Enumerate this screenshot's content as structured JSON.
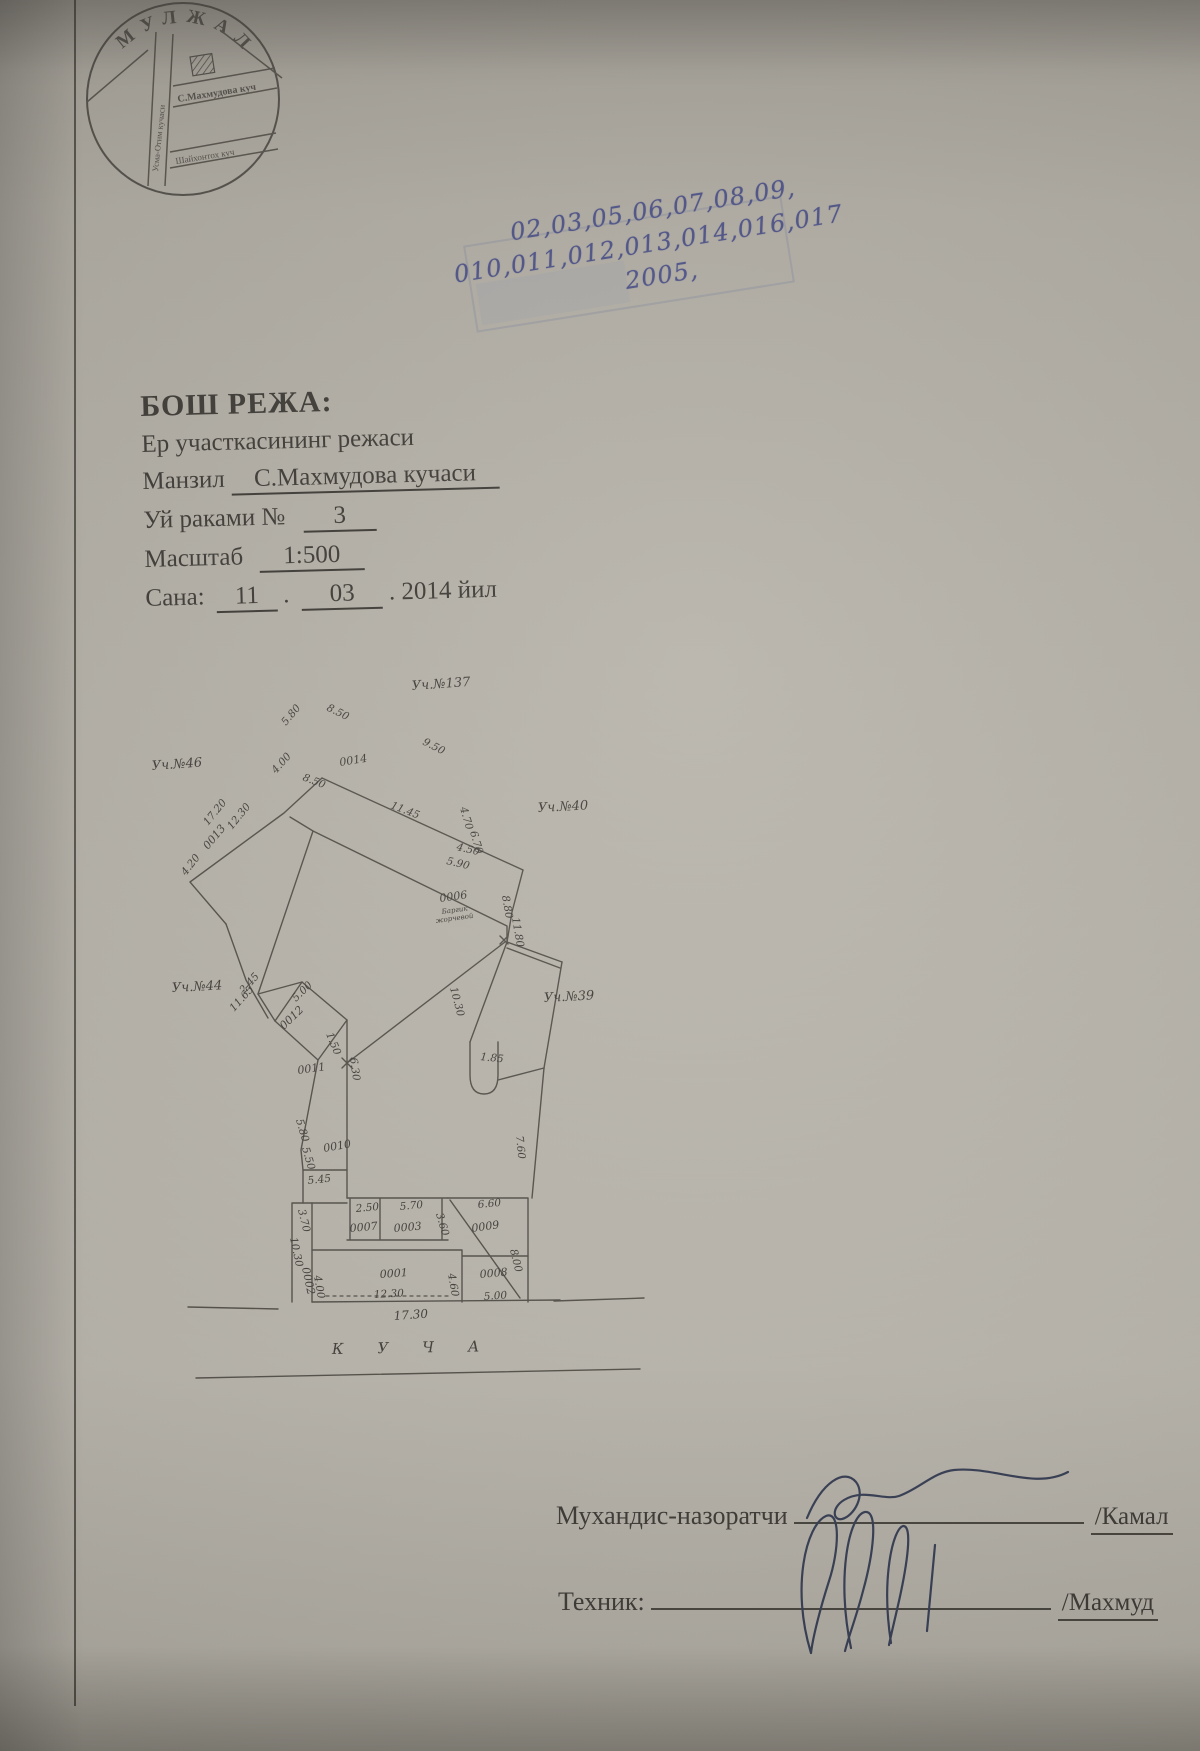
{
  "colors": {
    "paper": "#b7b3aa",
    "ink": "#57544d",
    "text": "#403d38",
    "pen_blue": "#4f5489",
    "signature_ink": "#3a4157"
  },
  "seal": {
    "arc": "МУЛЖАЛ",
    "street_vertical": "Усма-Отим кучаси",
    "street_horizontal": "С.Махмудова куч",
    "street_bottom": "Шайхонтох куч"
  },
  "stamp": {
    "line1": "02,03,05,06,07,08,09,",
    "line2": "010,011,012,013,014,016,017",
    "line3": "2005,"
  },
  "header": {
    "title": "БОШ РЕЖА:",
    "subtitle": "Ер участкасининг режаси",
    "address_label": "Манзил",
    "address_value": "С.Махмудова кучаси",
    "house_label": "Уй раками №",
    "house_value": "3",
    "scale_label": "Масштаб",
    "scale_value": "1:500",
    "date_label": "Сана:",
    "date_day": "11",
    "date_dot1": ".",
    "date_month": "03",
    "date_suffix": ". 2014 йил"
  },
  "plan": {
    "street_caption": "КУЧА",
    "labels": [
      {
        "t": "Уч.№137",
        "x": 262,
        "y": 40,
        "r": -4,
        "s": 13
      },
      {
        "t": "Уч.№46",
        "x": 2,
        "y": 120,
        "r": -4,
        "s": 13
      },
      {
        "t": "Уч.№40",
        "x": 388,
        "y": 162,
        "r": -3,
        "s": 13
      },
      {
        "t": "Уч.№44",
        "x": 22,
        "y": 342,
        "r": -3,
        "s": 13
      },
      {
        "t": "Уч.№39",
        "x": 394,
        "y": 352,
        "r": -3,
        "s": 13
      },
      {
        "t": "0014",
        "x": 190,
        "y": 116,
        "r": -9,
        "s": 11
      },
      {
        "t": "8.50",
        "x": 176,
        "y": 60,
        "r": 26,
        "s": 10.5
      },
      {
        "t": "5.80",
        "x": 136,
        "y": 76,
        "r": -50,
        "s": 10.5
      },
      {
        "t": "9.50",
        "x": 272,
        "y": 94,
        "r": 27,
        "s": 10.5
      },
      {
        "t": "4.00",
        "x": 126,
        "y": 124,
        "r": -48,
        "s": 10.5
      },
      {
        "t": "8.50",
        "x": 152,
        "y": 130,
        "r": 21,
        "s": 10.5
      },
      {
        "t": "11.45",
        "x": 240,
        "y": 158,
        "r": 21,
        "s": 10.5
      },
      {
        "t": "4.70",
        "x": 310,
        "y": 158,
        "r": 74,
        "s": 10.5
      },
      {
        "t": "6.70",
        "x": 320,
        "y": 182,
        "r": 74,
        "s": 10.5
      },
      {
        "t": "17.20",
        "x": 58,
        "y": 176,
        "r": -51,
        "s": 10.5
      },
      {
        "t": "12.30",
        "x": 82,
        "y": 180,
        "r": -51,
        "s": 10.5
      },
      {
        "t": "0013",
        "x": 58,
        "y": 200,
        "r": -50,
        "s": 11
      },
      {
        "t": "4.20",
        "x": 36,
        "y": 226,
        "r": -52,
        "s": 10.5
      },
      {
        "t": "4.50",
        "x": 306,
        "y": 200,
        "r": 13,
        "s": 10.5
      },
      {
        "t": "5.90",
        "x": 296,
        "y": 214,
        "r": 13,
        "s": 10.5
      },
      {
        "t": "0006",
        "x": 290,
        "y": 252,
        "r": -8,
        "s": 11
      },
      {
        "t": "Баргик",
        "x": 292,
        "y": 264,
        "r": -8,
        "s": 7
      },
      {
        "t": "жорчевой",
        "x": 286,
        "y": 273,
        "r": -8,
        "s": 7
      },
      {
        "t": "8.80",
        "x": 352,
        "y": 246,
        "r": 80,
        "s": 10.5
      },
      {
        "t": "11.80",
        "x": 362,
        "y": 268,
        "r": 80,
        "s": 10.5
      },
      {
        "t": "10.30",
        "x": 300,
        "y": 338,
        "r": 75,
        "s": 10.5
      },
      {
        "t": "1.85",
        "x": 330,
        "y": 410,
        "r": 6,
        "s": 10.5
      },
      {
        "t": "5.00",
        "x": 146,
        "y": 352,
        "r": -44,
        "s": 10.5
      },
      {
        "t": "2.45",
        "x": 94,
        "y": 344,
        "r": -48,
        "s": 10.5
      },
      {
        "t": "11.65",
        "x": 84,
        "y": 362,
        "r": -48,
        "s": 10.5
      },
      {
        "t": "0012",
        "x": 134,
        "y": 380,
        "r": -44,
        "s": 11
      },
      {
        "t": "1.50",
        "x": 176,
        "y": 384,
        "r": 68,
        "s": 10.5
      },
      {
        "t": "0011",
        "x": 148,
        "y": 424,
        "r": -8,
        "s": 11
      },
      {
        "t": "6.30",
        "x": 200,
        "y": 408,
        "r": 82,
        "s": 10.5
      },
      {
        "t": "5.80",
        "x": 146,
        "y": 470,
        "r": 74,
        "s": 10.5
      },
      {
        "t": "5.50",
        "x": 152,
        "y": 498,
        "r": 74,
        "s": 10.5
      },
      {
        "t": "0010",
        "x": 174,
        "y": 502,
        "r": -10,
        "s": 11
      },
      {
        "t": "7.60",
        "x": 366,
        "y": 486,
        "r": 84,
        "s": 10.5
      },
      {
        "t": "5.45",
        "x": 158,
        "y": 534,
        "r": -6,
        "s": 10.5
      },
      {
        "t": "3.70",
        "x": 148,
        "y": 560,
        "r": 76,
        "s": 10.5
      },
      {
        "t": "10.30",
        "x": 140,
        "y": 588,
        "r": 78,
        "s": 10.5
      },
      {
        "t": "0002",
        "x": 152,
        "y": 618,
        "r": 78,
        "s": 11
      },
      {
        "t": "2.50",
        "x": 206,
        "y": 562,
        "r": -5,
        "s": 10.5
      },
      {
        "t": "0007",
        "x": 200,
        "y": 582,
        "r": -5,
        "s": 11
      },
      {
        "t": "5.70",
        "x": 250,
        "y": 560,
        "r": -5,
        "s": 10.5
      },
      {
        "t": "0003",
        "x": 244,
        "y": 582,
        "r": -5,
        "s": 11
      },
      {
        "t": "3.60",
        "x": 286,
        "y": 564,
        "r": 74,
        "s": 10.5
      },
      {
        "t": "6.60",
        "x": 328,
        "y": 558,
        "r": -5,
        "s": 10.5
      },
      {
        "t": "0009",
        "x": 322,
        "y": 582,
        "r": -8,
        "s": 11
      },
      {
        "t": "0001",
        "x": 230,
        "y": 628,
        "r": -4,
        "s": 11
      },
      {
        "t": "12.30",
        "x": 224,
        "y": 648,
        "r": -3,
        "s": 10.5
      },
      {
        "t": "4.00",
        "x": 164,
        "y": 626,
        "r": 80,
        "s": 10.5
      },
      {
        "t": "4.60",
        "x": 298,
        "y": 624,
        "r": 80,
        "s": 10.5
      },
      {
        "t": "0008",
        "x": 330,
        "y": 628,
        "r": -5,
        "s": 11
      },
      {
        "t": "5.00",
        "x": 334,
        "y": 650,
        "r": -4,
        "s": 10.5
      },
      {
        "t": "8.00",
        "x": 360,
        "y": 600,
        "r": 76,
        "s": 10.5
      },
      {
        "t": "17.30",
        "x": 244,
        "y": 670,
        "r": -4,
        "s": 12
      }
    ]
  },
  "signatures": {
    "row1_label": "Мухандис-назоратчи",
    "row1_name": "/Камал",
    "row2_label": "Техник:",
    "row2_name": "/Махмуд"
  }
}
